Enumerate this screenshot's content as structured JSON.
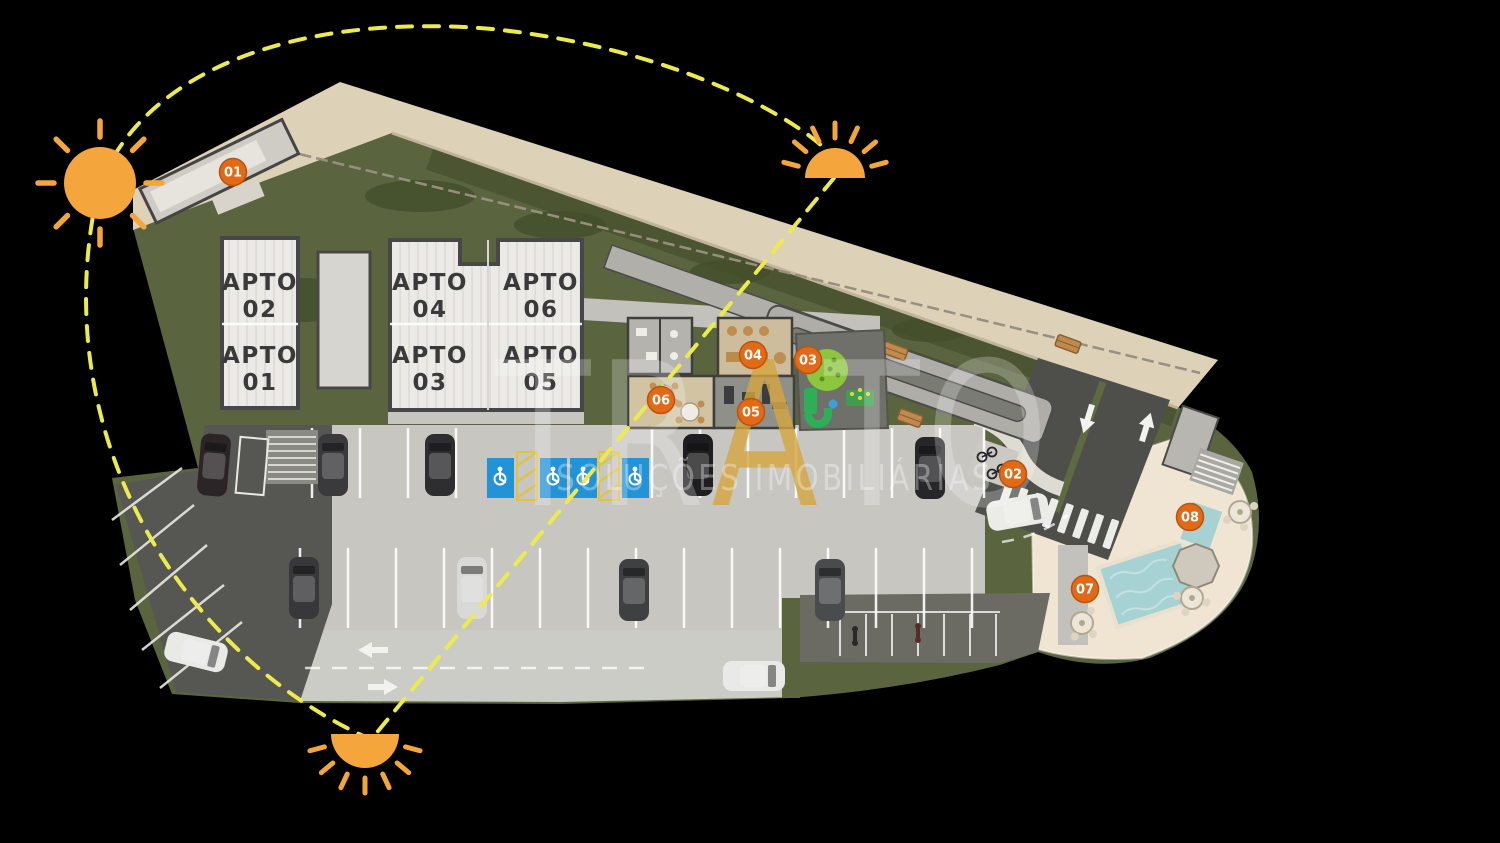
{
  "plan": {
    "apartments": [
      {
        "label": "APTO",
        "number": "02"
      },
      {
        "label": "APTO",
        "number": "04"
      },
      {
        "label": "APTO",
        "number": "06"
      },
      {
        "label": "APTO",
        "number": "01"
      },
      {
        "label": "APTO",
        "number": "03"
      },
      {
        "label": "APTO",
        "number": "05"
      }
    ],
    "markers": [
      {
        "label": "01"
      },
      {
        "label": "02"
      },
      {
        "label": "03"
      },
      {
        "label": "04"
      },
      {
        "label": "05"
      },
      {
        "label": "06"
      },
      {
        "label": "07"
      },
      {
        "label": "08"
      }
    ]
  },
  "watermark": {
    "brand_left": "TR",
    "brand_accent": "A",
    "brand_right": "TO",
    "tagline": "SOLUÇÕES IMOBILIÁRIAS"
  },
  "colors": {
    "background": "#000000",
    "grass": "#5A6540",
    "road": "#DDD1B8",
    "deck": "#F0E4D2",
    "parking": "#C7C6C1",
    "asphalt": "#565753",
    "building": "#ECEAE6",
    "pool": "#A7D2D3",
    "accessible_blue": "#2293D6",
    "marker": "#E26A17",
    "sun": "#F4A63C",
    "sun_path": "#ECEB4E",
    "watermark_gold": "#D5A63E"
  }
}
